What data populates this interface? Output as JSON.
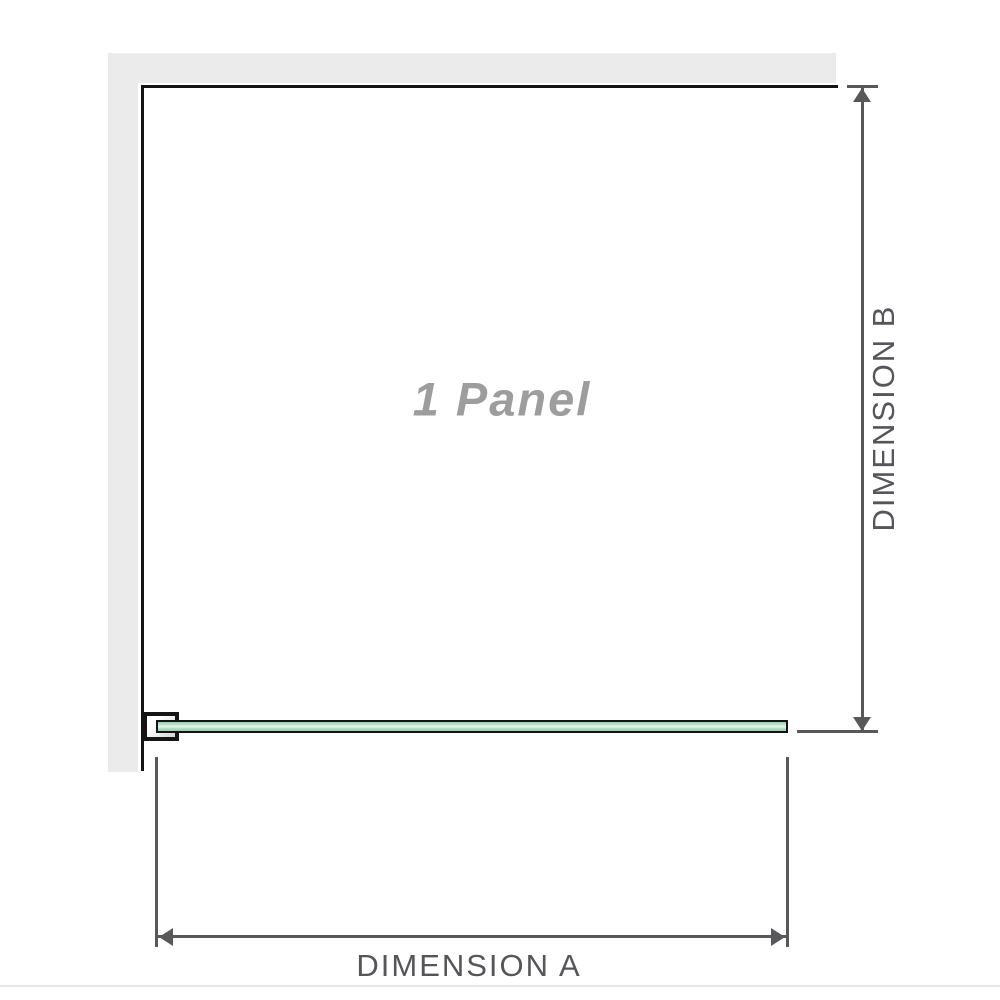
{
  "diagram": {
    "panel_label": "1 Panel",
    "dimension_a_label": "DIMENSION A",
    "dimension_b_label": "DIMENSION B"
  },
  "icons": {
    "arrow_up": "arrow-up-icon",
    "arrow_down": "arrow-down-icon",
    "arrow_left": "arrow-left-icon",
    "arrow_right": "arrow-right-icon"
  },
  "colors": {
    "wall": "#ebebeb",
    "outline": "#141414",
    "dim": "#58585a",
    "label_text": "#55565a",
    "panel_text": "#9d9d9d",
    "glass_dark": "#93d0ae",
    "glass_light": "#eaf7ef",
    "divider": "#e7e7e1"
  }
}
